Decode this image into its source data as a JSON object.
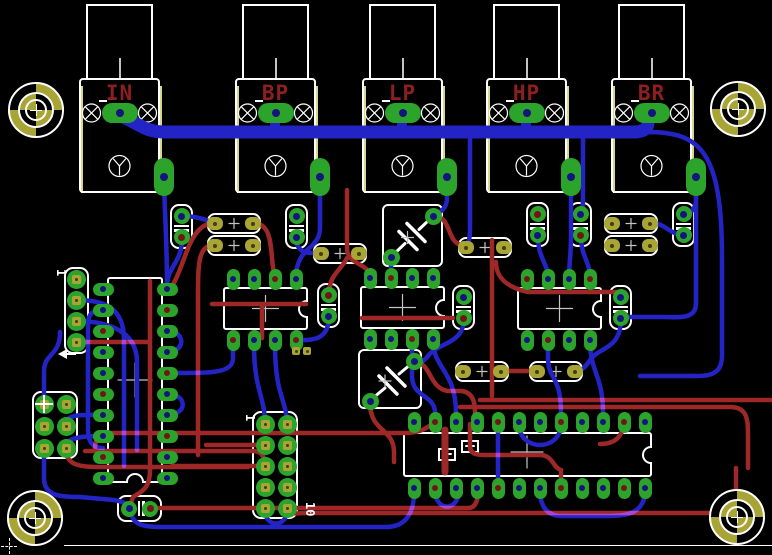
{
  "app": {
    "view": "pcb-board-layout"
  },
  "palette": {
    "bg": "#000000",
    "copper_bottom_blue": "#2424c6",
    "copper_top_red": "#9e2828",
    "pad_green": "#2ca42c",
    "pad_olive": "#a8a435",
    "silkscreen_white": "#ffffff",
    "dimension_yellow": "#d8d88c",
    "label_dark_red": "#8e1f1f",
    "hole_navy": "#15157d",
    "hole_dark_red": "#701616",
    "hole_olive": "#3f3f10",
    "crosshair_gray": "#c4c4c4"
  },
  "jacks": {
    "body_y": 78,
    "body_w": 81,
    "body_h": 115,
    "shaft_y": 4,
    "shaft_w": 67,
    "shaft_h": 76,
    "items": [
      {
        "label": "IN",
        "x": 79
      },
      {
        "label": "BP",
        "x": 235
      },
      {
        "label": "LP",
        "x": 362
      },
      {
        "label": "HP",
        "x": 486
      },
      {
        "label": "BR",
        "x": 611
      }
    ]
  },
  "mounting_holes": [
    {
      "pos": "top-left",
      "x": 36,
      "y": 110
    },
    {
      "pos": "top-right",
      "x": 738,
      "y": 109
    },
    {
      "pos": "bottom-left",
      "x": 35,
      "y": 518
    },
    {
      "pos": "bottom-right",
      "x": 737,
      "y": 517
    }
  ],
  "ics": {
    "dip8": [
      {
        "id": "ic-dip8-1",
        "x": 223,
        "y": 287
      },
      {
        "id": "ic-dip8-2",
        "x": 360,
        "y": 286
      },
      {
        "id": "ic-dip8-3",
        "x": 517,
        "y": 287
      }
    ],
    "dip20": {
      "id": "ic-dip20",
      "x": 107,
      "y": 277,
      "w": 56,
      "h": 206,
      "rows": 10,
      "cols": [
        103,
        167
      ],
      "row0": 289,
      "pitch": 21,
      "cross": [
        135,
        380
      ]
    },
    "dip24": {
      "id": "ic-dip24",
      "x": 403,
      "y": 432,
      "w": 249,
      "h": 45,
      "cols": 12,
      "col0": 414,
      "pitch": 21,
      "cross": [
        527,
        452
      ],
      "plus_boxes": [
        [
          447,
          454
        ],
        [
          470,
          446
        ]
      ]
    }
  },
  "resistors": [
    [
      207,
      213
    ],
    [
      207,
      235
    ],
    [
      313,
      243
    ],
    [
      458,
      237
    ],
    [
      604,
      213
    ],
    [
      604,
      235
    ],
    [
      455,
      361
    ],
    [
      529,
      361
    ]
  ],
  "caps_vertical": [
    [
      170,
      204
    ],
    [
      285,
      204
    ],
    [
      526,
      202
    ],
    [
      569,
      202
    ],
    [
      672,
      202
    ],
    [
      317,
      283
    ],
    [
      452,
      285
    ],
    [
      609,
      285
    ]
  ],
  "caps_horizontal": [
    [
      117,
      495
    ]
  ],
  "film_caps": [
    {
      "x": 382,
      "y": 204,
      "w": 61,
      "h": 63,
      "p1": [
        433,
        216
      ],
      "p2": [
        391,
        257
      ]
    },
    {
      "x": 358,
      "y": 349,
      "w": 64,
      "h": 60,
      "p1": [
        414,
        361
      ],
      "p2": [
        370,
        401
      ]
    }
  ],
  "headers": [
    {
      "id": "pin-header-1x4",
      "x": 64,
      "y": 267,
      "w": 25,
      "h": 87,
      "cols": [
        76
      ],
      "rows": [
        279,
        300,
        321,
        342
      ],
      "label_top": "1",
      "arrow": true
    },
    {
      "id": "pin-header-2x3",
      "x": 32,
      "y": 391,
      "w": 46,
      "h": 68,
      "cols": [
        44,
        66
      ],
      "rows": [
        404,
        426,
        448
      ],
      "pin1_cross": true
    },
    {
      "id": "pin-header-2x5",
      "x": 252,
      "y": 411,
      "w": 46,
      "h": 108,
      "cols": [
        265,
        287
      ],
      "rows": [
        424,
        445,
        466,
        487,
        508
      ],
      "label_top": "1",
      "label_bottom": "10"
    }
  ],
  "vias": [
    [
      296,
      351
    ],
    [
      307,
      351
    ]
  ],
  "board": {
    "bottom_line": {
      "x": 64,
      "y": 545,
      "w": 708
    },
    "origin_marker": {
      "x": 9,
      "y": 546
    }
  },
  "traces": {
    "bottom_blue": [
      [
        "M121 116 C140 124 144 132 166 132 L634 132 C649 132 650 123 646 115",
        13
      ],
      [
        "M275 113 V130",
        10
      ],
      [
        "M402 113 V130",
        10
      ],
      [
        "M526 113 V130",
        10
      ],
      [
        "M164 179 C164 205 167 232 167 289",
        4.5
      ],
      [
        "M320 179 V228 C320 250 296 246 296 278",
        4.5
      ],
      [
        "M447 179 V198 C447 210 439 211 435 217",
        4.5
      ],
      [
        "M391 257 V278",
        4.5
      ],
      [
        "M571 179 V235 C571 258 569 262 569 278",
        4.5
      ],
      [
        "M696 179 V199 C696 209 691 212 686 215",
        4.5
      ],
      [
        "M684 235 C670 235 665 223 652 223",
        4.5
      ],
      [
        "M696 196 V303 C696 320 679 317 662 317 L623 317",
        4.5
      ],
      [
        "M647 132 C700 132 722 150 722 258 V356 C722 378 704 376 687 376 L640 376",
        4.5
      ],
      [
        "M182 239 C182 262 168 266 167 285",
        4.5
      ],
      [
        "M76 300 C104 300 124 307 124 340 V466",
        4.5
      ],
      [
        "M76 321 C100 321 137 327 137 362 V450",
        4.5
      ],
      [
        "M44 404 V372 C44 352 60 357 60 332",
        4.5
      ],
      [
        "M44 448 V478 C44 496 60 497 80 497 L114 500 C124 502 127 504 130 507",
        4.5
      ],
      [
        "M470 132 V228 C470 241 468 243 466 246",
        4.5
      ],
      [
        "M583 132 V198 C583 207 582 210 581 214",
        4.5
      ],
      [
        "M538 236 C538 259 548 263 548 278",
        4.5
      ],
      [
        "M581 236 C581 257 590 261 590 278",
        4.5
      ],
      [
        "M265 424 C265 396 254 391 254 344",
        4.5
      ],
      [
        "M287 424 C287 400 275 397 275 344",
        4.5
      ],
      [
        "M412 341 V376 C412 398 435 394 435 413",
        4.5
      ],
      [
        "M433 341 C433 368 456 371 456 413",
        4.5
      ],
      [
        "M548 341 V358 C548 380 561 375 561 413",
        4.5
      ],
      [
        "M590 341 C590 372 603 375 603 413",
        4.5
      ],
      [
        "M519 424 C519 452 561 452 561 424",
        4.5
      ],
      [
        "M498 424 V488",
        4.5
      ],
      [
        "M131 510 C131 526 146 527 162 527 L386 527 C408 527 414 510 414 492",
        4.5
      ],
      [
        "M265 510 C265 528 287 528 287 510",
        4.5
      ],
      [
        "M645 490 C645 517 621 516 601 516 L562 516 C543 516 540 501 540 490",
        4.5
      ],
      [
        "M103 415 C86 415 66 413 66 424",
        4.5
      ],
      [
        "M103 436 C86 436 66 437 66 446",
        4.5
      ],
      [
        "M167 331 C186 331 186 352 167 352",
        4.5
      ],
      [
        "M167 394 C188 394 188 415 167 415",
        4.5
      ],
      [
        "M182 216 C198 216 204 220 213 222",
        4.5
      ],
      [
        "M296 237 C296 256 312 253 321 253",
        4.5
      ],
      [
        "M464 318 C464 345 438 342 428 356 C422 364 419 361 414 361",
        4.5
      ],
      [
        "M621 318 C621 350 600 346 590 360 C585 368 581 371 575 371",
        4.5
      ],
      [
        "M233 341 V358 C233 374 210 373 167 373",
        4.5
      ],
      [
        "M329 316 C329 342 310 340 298 340",
        4.5
      ],
      [
        "M435 490 C435 512 459 512 459 490",
        4.5
      ],
      [
        "M103 310 C88 310 88 318 88 330 V430 C88 445 95 448 103 448",
        4.5
      ]
    ],
    "top_red": [
      [
        "M76 342 H149",
        4.5
      ],
      [
        "M150 281 V470",
        4.5
      ],
      [
        "M150 470 C150 490 140 492 133 497 L130 506",
        4.5
      ],
      [
        "M151 508 H468 C477 508 478 498 478 491",
        4.5
      ],
      [
        "M287 510 C287 515 297 513 308 513 L718 513 C736 513 736 500 736 486 V468",
        4.5
      ],
      [
        "M215 223 C186 223 186 272 167 293",
        4.5
      ],
      [
        "M253 223 C276 223 269 258 275 278",
        4.5
      ],
      [
        "M215 245 C198 245 198 262 198 300 V455",
        4.5
      ],
      [
        "M212 304 H306",
        4.5
      ],
      [
        "M262 304 V338",
        4.5
      ],
      [
        "M362 318 H453",
        4.5
      ],
      [
        "M496 262 C496 280 510 288 528 292 L618 292",
        4.5
      ],
      [
        "M414 362 C432 362 428 388 448 391 L462 391 C474 393 475 404 475 413",
        4.5
      ],
      [
        "M370 403 C370 432 394 428 394 452 V462",
        4.5
      ],
      [
        "M265 466 H172",
        4.5
      ],
      [
        "M265 445 H206",
        4.5
      ],
      [
        "M66 450 C66 467 84 467 104 467 L248 467",
        4.5
      ],
      [
        "M95 448 C95 437 103 433 114 433 L404 433 C422 433 427 427 433 424",
        4.5
      ],
      [
        "M480 400 H772",
        4.5
      ],
      [
        "M460 407 H730 C748 407 748 420 748 438 V468",
        4.5
      ],
      [
        "M445 430 V472",
        7
      ],
      [
        "M470 424 V446 C470 456 480 455 492 455 L540 455 C553 455 553 468 561 470 V488",
        4.5
      ],
      [
        "M492 240 V396",
        4.5
      ],
      [
        "M85 451 H253 C262 451 265 458 265 464",
        4.5
      ],
      [
        "M347 190 V248 C347 266 370 262 370 278",
        4.5
      ],
      [
        "M433 216 C452 216 446 241 461 245 L466 246",
        4.5
      ],
      [
        "M329 295 C329 274 340 272 347 258",
        4.5
      ],
      [
        "M501 371 H537",
        4.5
      ],
      [
        "M600 444 C620 444 622 431 624 426",
        4.5
      ]
    ]
  }
}
